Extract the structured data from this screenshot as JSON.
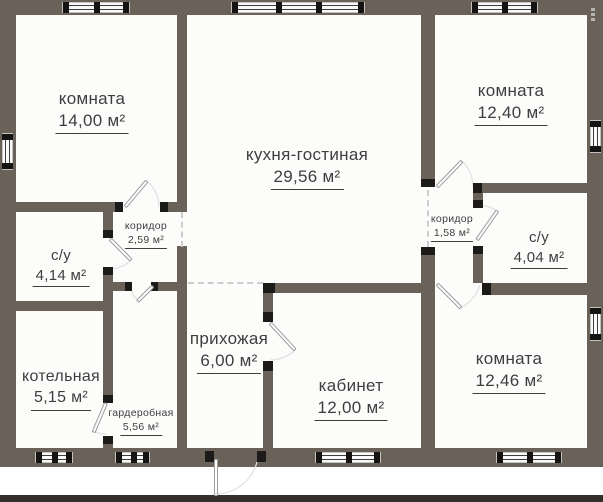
{
  "plan": {
    "type": "floor-plan",
    "rooms": [
      {
        "id": "room-top-left",
        "name": "комната",
        "area": "14,00 м²"
      },
      {
        "id": "kitchen-living",
        "name": "кухня-гостиная",
        "area": "29,56 м²"
      },
      {
        "id": "room-top-right",
        "name": "комната",
        "area": "12,40 м²"
      },
      {
        "id": "corridor-left",
        "name": "коридор",
        "area": "2,59 м²"
      },
      {
        "id": "corridor-right",
        "name": "коридор",
        "area": "1,58 м²"
      },
      {
        "id": "bathroom-left",
        "name": "с/у",
        "area": "4,14 м²"
      },
      {
        "id": "bathroom-right",
        "name": "с/у",
        "area": "4,04 м²"
      },
      {
        "id": "hallway",
        "name": "прихожая",
        "area": "6,00 м²"
      },
      {
        "id": "boiler-room",
        "name": "котельная",
        "area": "5,15 м²"
      },
      {
        "id": "wardrobe",
        "name": "гардеробная",
        "area": "5,56 м²"
      },
      {
        "id": "office",
        "name": "кабинет",
        "area": "12,00 м²"
      },
      {
        "id": "room-bottom-right",
        "name": "комната",
        "area": "12,46 м²"
      }
    ],
    "icons": {
      "more_options": "more-options-dots"
    },
    "colors": {
      "wall": "#6a6159",
      "door_cap": "#1d1b19",
      "text": "#3e3e3e",
      "floor": "#fcfcfb",
      "ground_line": "#332e29",
      "background": "#ffffff"
    }
  }
}
